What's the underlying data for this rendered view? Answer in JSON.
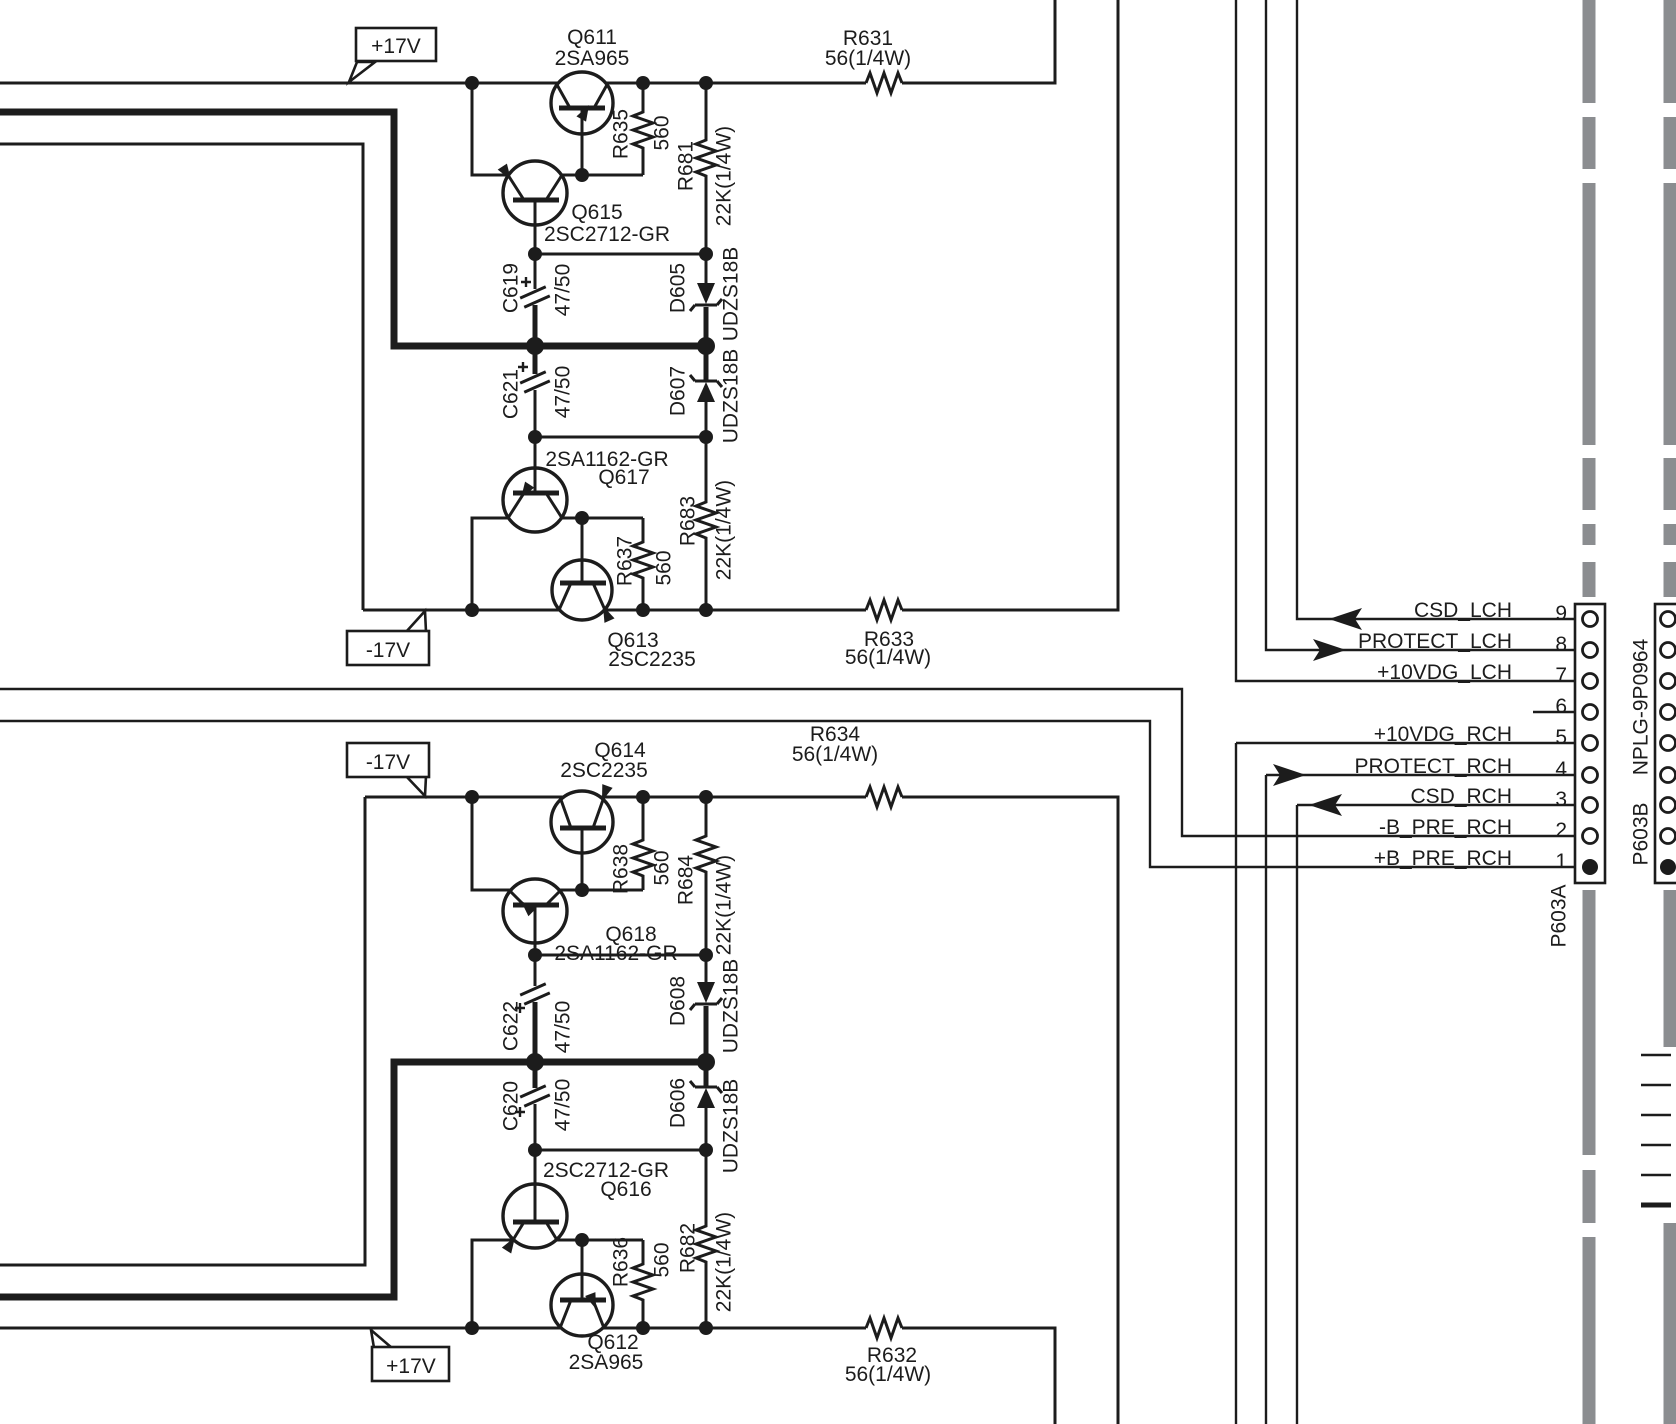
{
  "schematic": {
    "power_rails": {
      "plus17_top": "+17V",
      "minus17_top": "-17V",
      "minus17_bottom": "-17V",
      "plus17_bottom": "+17V"
    },
    "components": {
      "q611": {
        "ref": "Q611",
        "part": "2SA965"
      },
      "q615": {
        "ref": "Q615",
        "part": "2SC2712-GR"
      },
      "q617": {
        "ref": "Q617",
        "part": "2SA1162-GR"
      },
      "q613": {
        "ref": "Q613",
        "part": "2SC2235"
      },
      "q614": {
        "ref": "Q614",
        "part": "2SC2235"
      },
      "q618": {
        "ref": "Q618",
        "part": "2SA1162-GR"
      },
      "q616": {
        "ref": "Q616",
        "part": "2SC2712-GR"
      },
      "q612": {
        "ref": "Q612",
        "part": "2SA965"
      },
      "r631": {
        "ref": "R631",
        "value": "56(1/4W)"
      },
      "r632": {
        "ref": "R632",
        "value": "56(1/4W)"
      },
      "r633": {
        "ref": "R633",
        "value": "56(1/4W)"
      },
      "r634": {
        "ref": "R634",
        "value": "56(1/4W)"
      },
      "r635": {
        "ref": "R635",
        "value": "560"
      },
      "r636": {
        "ref": "R636",
        "value": "560"
      },
      "r637": {
        "ref": "R637",
        "value": "560"
      },
      "r638": {
        "ref": "R638",
        "value": "560"
      },
      "r681": {
        "ref": "R681",
        "value": "22K(1/4W)"
      },
      "r682": {
        "ref": "R682",
        "value": "22K(1/4W)"
      },
      "r683": {
        "ref": "R683",
        "value": "22K(1/4W)"
      },
      "r684": {
        "ref": "R684",
        "value": "22K(1/4W)"
      },
      "c619": {
        "ref": "C619",
        "value": "47/50"
      },
      "c620": {
        "ref": "C620",
        "value": "47/50"
      },
      "c621": {
        "ref": "C621",
        "value": "47/50"
      },
      "c622": {
        "ref": "C622",
        "value": "47/50"
      },
      "d605": {
        "ref": "D605",
        "part": "UDZS18B"
      },
      "d606": {
        "ref": "D606",
        "part": "UDZS18B"
      },
      "d607": {
        "ref": "D607",
        "part": "UDZS18B"
      },
      "d608": {
        "ref": "D608",
        "part": "UDZS18B"
      }
    },
    "connector": {
      "plug_name": "P603A",
      "jack_name": "P603B",
      "jack_part": "NPLG-9P0964",
      "pins": [
        {
          "number": "9",
          "signal": "CSD_LCH",
          "arrow": "left"
        },
        {
          "number": "8",
          "signal": "PROTECT_LCH",
          "arrow": "right"
        },
        {
          "number": "7",
          "signal": "+10VDG_LCH",
          "arrow": "none"
        },
        {
          "number": "6",
          "signal": "",
          "arrow": "none"
        },
        {
          "number": "5",
          "signal": "+10VDG_RCH",
          "arrow": "none"
        },
        {
          "number": "4",
          "signal": "PROTECT_RCH",
          "arrow": "right"
        },
        {
          "number": "3",
          "signal": "CSD_RCH",
          "arrow": "left"
        },
        {
          "number": "2",
          "signal": "-B_PRE_RCH",
          "arrow": "none"
        },
        {
          "number": "1",
          "signal": "+B_PRE_RCH",
          "arrow": "none"
        }
      ]
    },
    "colors": {
      "line": "#1c1c1c",
      "board_edge": "#8b8d90",
      "background": "#ffffff"
    }
  }
}
